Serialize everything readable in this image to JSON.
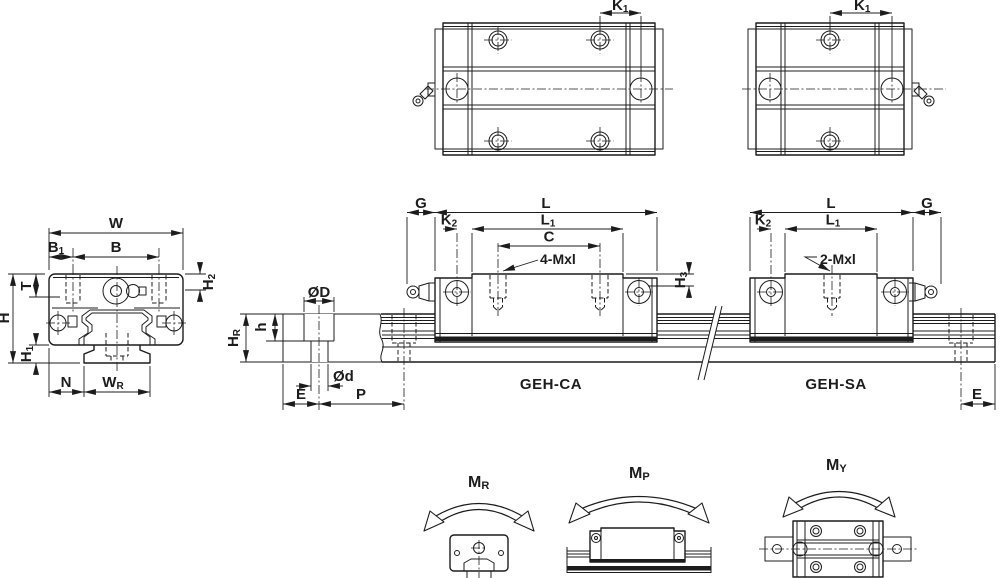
{
  "colors": {
    "background": "#ffffff",
    "line": "#1c1c1c"
  },
  "labels": {
    "k1_ca": {
      "main": "K",
      "sub": "1"
    },
    "k1_sa": {
      "main": "K",
      "sub": "1"
    },
    "w": "W",
    "b1": {
      "main": "B",
      "sub": "1"
    },
    "b": "B",
    "t": "T",
    "h": "H",
    "h1": {
      "main": "H",
      "sub": "1"
    },
    "h2": {
      "main": "H",
      "sub": "2"
    },
    "n": "N",
    "wr": {
      "main": "W",
      "sub": "R"
    },
    "od_big": "ØD",
    "od_small": "Ød",
    "h_depth": "h",
    "hr": {
      "main": "H",
      "sub": "R"
    },
    "e_left": "E",
    "p": "P",
    "e_right": "E",
    "g_ca": "G",
    "l_ca": "L",
    "l1_ca": {
      "main": "L",
      "sub": "1"
    },
    "k2_ca": {
      "main": "K",
      "sub": "2"
    },
    "c": "C",
    "thread_ca": "4-Mxl",
    "h3": {
      "main": "H",
      "sub": "3"
    },
    "geh_ca": "GEH-CA",
    "l_sa": "L",
    "g_sa": "G",
    "l1_sa": {
      "main": "L",
      "sub": "1"
    },
    "k2_sa": {
      "main": "K",
      "sub": "2"
    },
    "thread_sa": "2-Mxl",
    "geh_sa": "GEH-SA",
    "mr": {
      "main": "M",
      "sub": "R"
    },
    "mp": {
      "main": "M",
      "sub": "P"
    },
    "my": {
      "main": "M",
      "sub": "Y"
    }
  }
}
